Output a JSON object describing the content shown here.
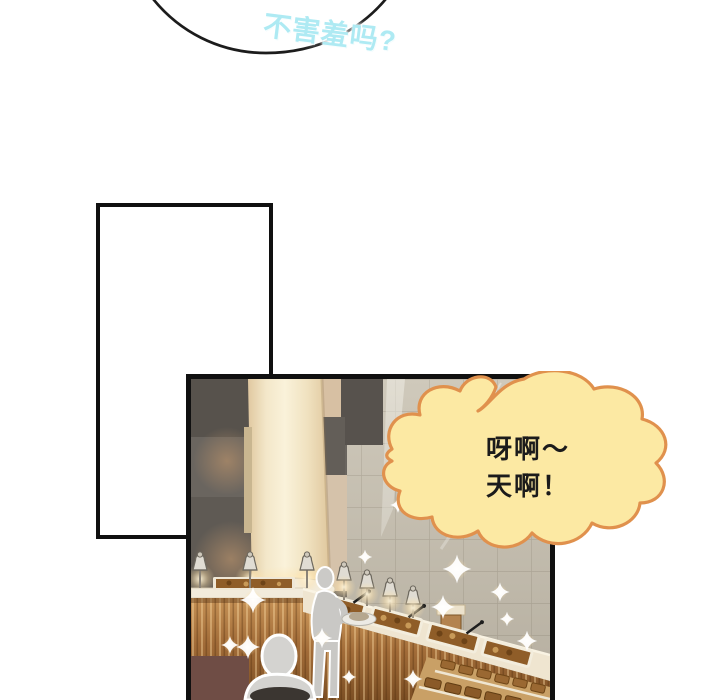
{
  "page": {
    "width": 720,
    "height": 700,
    "background": "#ffffff"
  },
  "top_bubble": {
    "text": "不害羞吗?",
    "text_color": "#aeeaf3",
    "glow_color": "#ffffff",
    "outline_color": "#1c1c1c"
  },
  "empty_panel": {
    "fill": "#ffffff",
    "border_color": "#101010"
  },
  "scene_panel": {
    "border_color": "#101010",
    "palette": {
      "wall_dark_gray": "#6a655f",
      "wall_tan": "#d7c0a3",
      "pillar_cream": "#f3e7c9",
      "tile_wall": "#cfc9bb",
      "counter_gold": "#a26c38",
      "counter_ledge": "#f2ebdb",
      "food_brown": "#8f5d28",
      "figure_gray": "#c9c8c5",
      "sparkle": "#ffffff"
    }
  },
  "shout_bubble": {
    "line1": "呀啊～",
    "line2": "天啊！",
    "fill": "#fce9a3",
    "stroke": "#e0914d",
    "text_color": "#1b1b1b"
  }
}
